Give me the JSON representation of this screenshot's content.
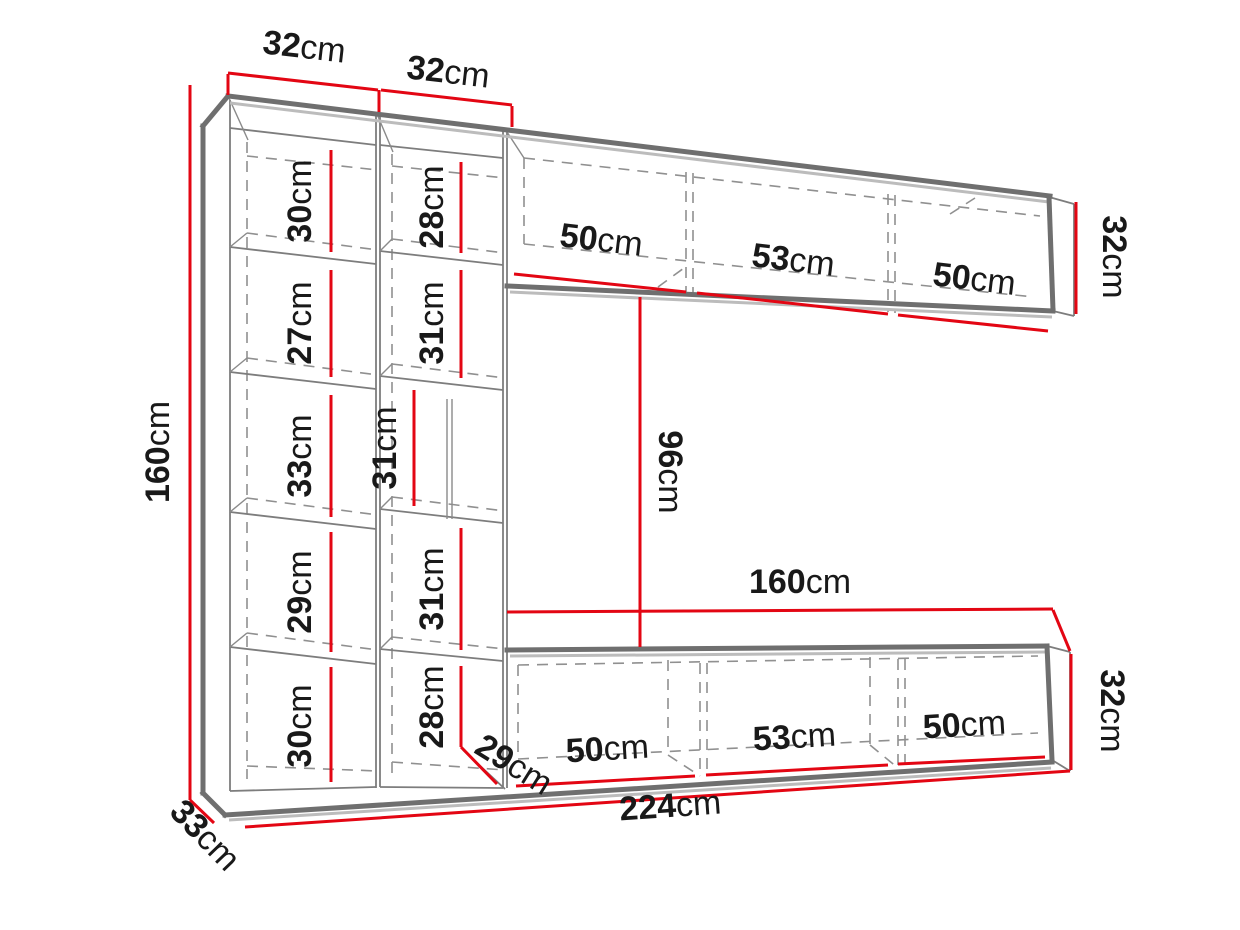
{
  "diagram": {
    "kind": "furniture-wall-unit-dimension-diagram",
    "unit": "cm",
    "colors": {
      "dimension_line": "#e30613",
      "furniture_outline": "#6f6f6f",
      "hidden_edge": "#909090",
      "label_text": "#191919",
      "background": "#ffffff"
    },
    "dims": {
      "total_height": {
        "value": "160",
        "unit": "cm"
      },
      "col1_width": {
        "value": "32",
        "unit": "cm"
      },
      "col2_width": {
        "value": "32",
        "unit": "cm"
      },
      "col1_c1": {
        "value": "30",
        "unit": "cm"
      },
      "col1_c2": {
        "value": "27",
        "unit": "cm"
      },
      "col1_c3": {
        "value": "33",
        "unit": "cm"
      },
      "col1_c4": {
        "value": "29",
        "unit": "cm"
      },
      "col1_c5": {
        "value": "30",
        "unit": "cm"
      },
      "col2_c1": {
        "value": "28",
        "unit": "cm"
      },
      "col2_c2": {
        "value": "31",
        "unit": "cm"
      },
      "col2_c3": {
        "value": "31",
        "unit": "cm"
      },
      "col2_c4": {
        "value": "31",
        "unit": "cm"
      },
      "col2_c5": {
        "value": "28",
        "unit": "cm"
      },
      "top_sec1": {
        "value": "50",
        "unit": "cm"
      },
      "top_sec2": {
        "value": "53",
        "unit": "cm"
      },
      "top_sec3": {
        "value": "50",
        "unit": "cm"
      },
      "top_height": {
        "value": "32",
        "unit": "cm"
      },
      "gap_height": {
        "value": "96",
        "unit": "cm"
      },
      "bottom_length": {
        "value": "160",
        "unit": "cm"
      },
      "bot_sec1": {
        "value": "50",
        "unit": "cm"
      },
      "bot_sec2": {
        "value": "53",
        "unit": "cm"
      },
      "bot_sec3": {
        "value": "50",
        "unit": "cm"
      },
      "bot_height": {
        "value": "32",
        "unit": "cm"
      },
      "bot_depth": {
        "value": "29",
        "unit": "cm"
      },
      "total_width": {
        "value": "224",
        "unit": "cm"
      },
      "side_depth": {
        "value": "33",
        "unit": "cm"
      }
    }
  }
}
